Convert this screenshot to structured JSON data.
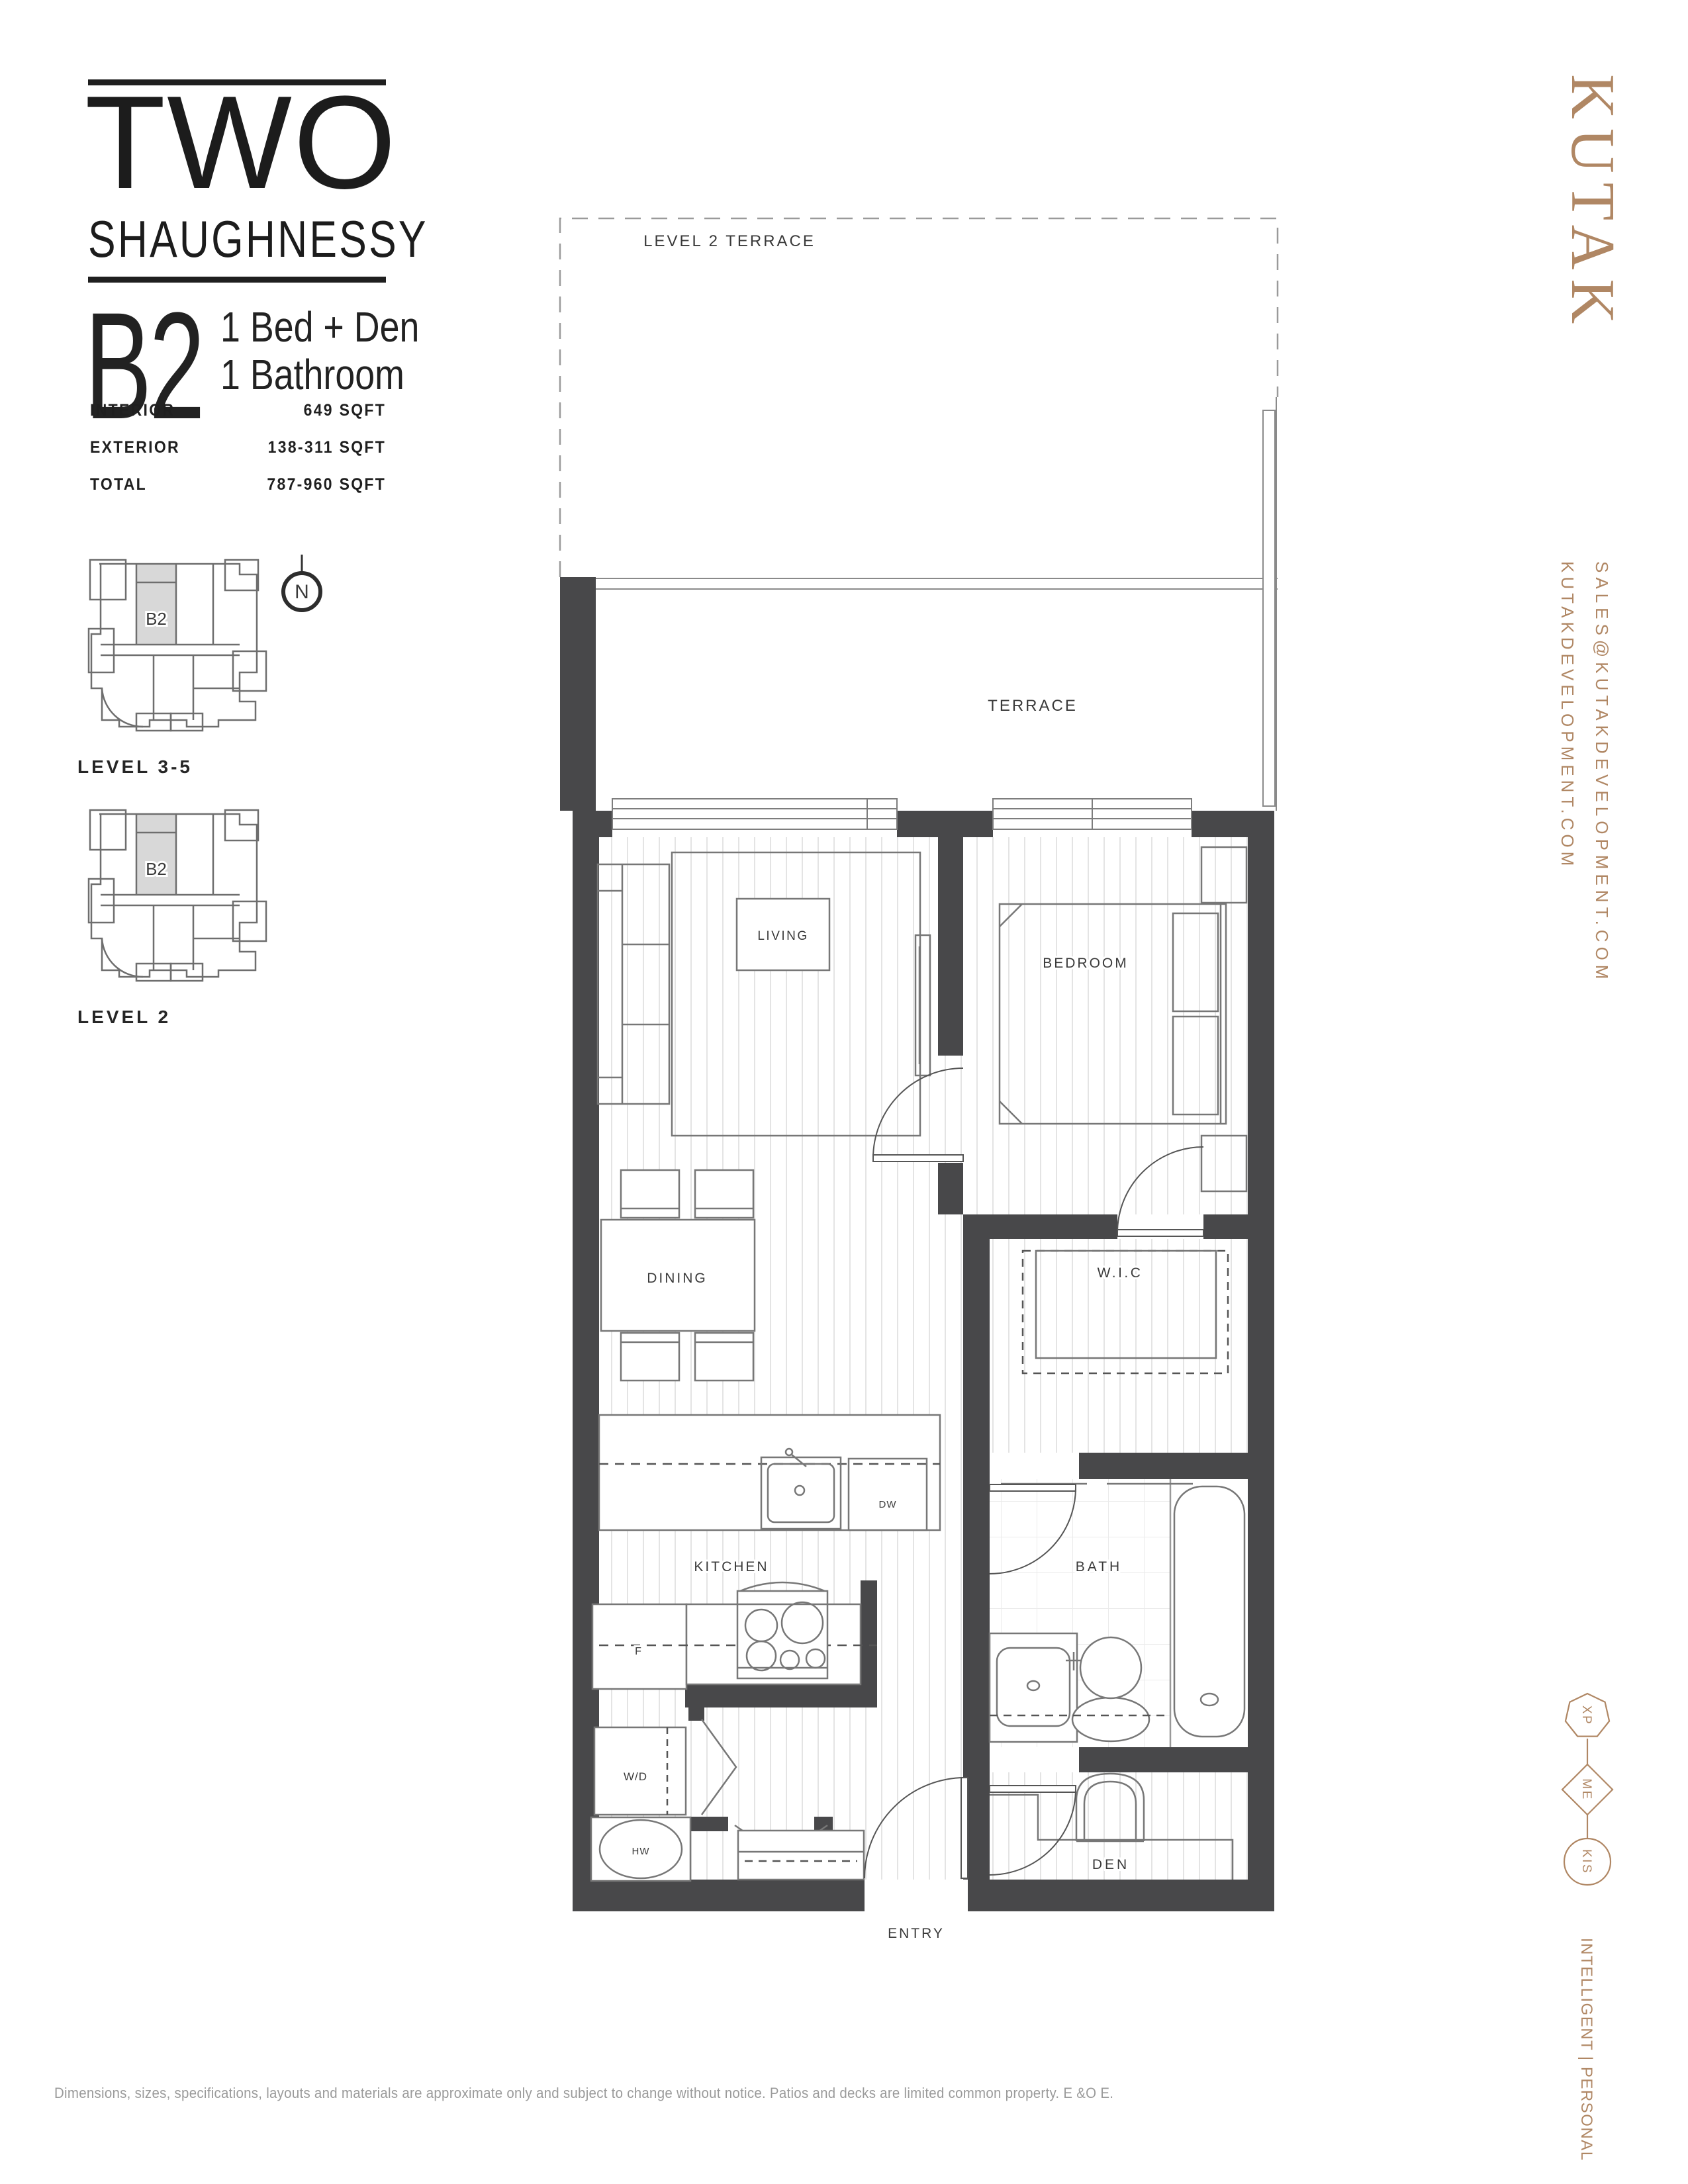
{
  "header": {
    "brand_line1": "TWO",
    "brand_line2": "SHAUGHNESSY",
    "unit_code": "B2",
    "unit_type_line1": "1 Bed + Den",
    "unit_type_line2": "1  Bathroom",
    "specs": [
      {
        "label": "INTERIOR",
        "value": "649 SQFT"
      },
      {
        "label": "EXTERIOR",
        "value": "138-311 SQFT"
      },
      {
        "label": "TOTAL",
        "value": "787-960 SQFT"
      }
    ]
  },
  "keyplans": {
    "plan1_label": "LEVEL 3-5",
    "plan2_label": "LEVEL 2",
    "unit_code": "B2",
    "compass": "N"
  },
  "plan": {
    "rooms": {
      "level2_terrace": "LEVEL 2 TERRACE",
      "terrace": "TERRACE",
      "living": "LIVING",
      "bedroom": "BEDROOM",
      "dining": "DINING",
      "wic": "W.I.C",
      "kitchen": "KITCHEN",
      "bath": "BATH",
      "den": "DEN",
      "entry": "ENTRY"
    },
    "appliances": {
      "fridge": "F",
      "dishwasher": "DW",
      "washer_dryer": "W/D",
      "hot_water": "HW"
    }
  },
  "brand_rail": {
    "logo": "KUTAK",
    "email": "SALES@KUTAKDEVELOPMENT.COM",
    "website": "KUTAKDEVELOPMENT.COM",
    "badges": [
      "XP",
      "ME",
      "KIS"
    ],
    "tagline": "INTELLIGENT | PERSONAL"
  },
  "footer": {
    "disclaimer": "Dimensions, sizes, specifications, layouts and materials are approximate only and subject to change without notice. Patios and decks are limited common property. E &O E."
  },
  "colors": {
    "accent": "#b08764",
    "wall": "#48484a"
  }
}
